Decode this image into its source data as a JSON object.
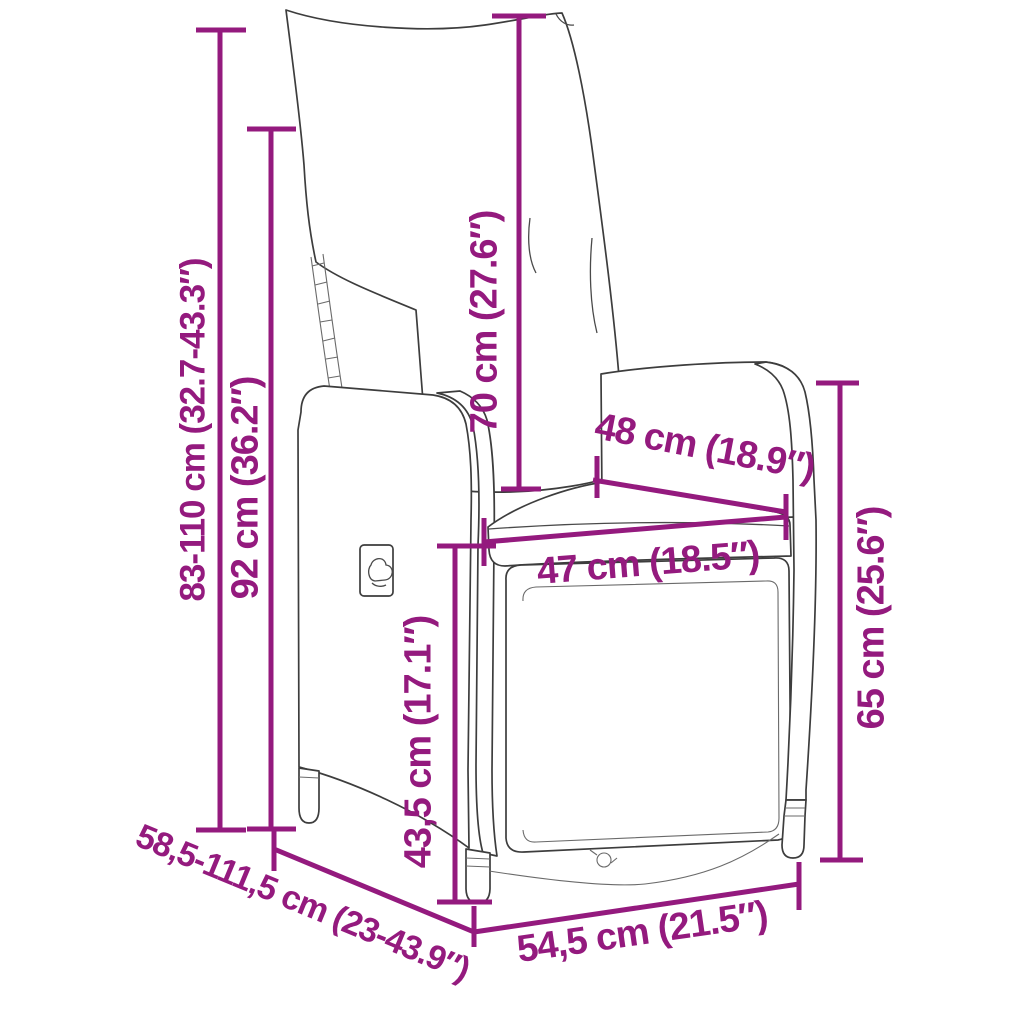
{
  "colors": {
    "accent": "#941A7E",
    "line_art": "#3d3d3d",
    "background": "#ffffff"
  },
  "diagram": {
    "kind": "product-dimension-diagram",
    "subject": "reclining rattan garden chair with cushions, front-left view"
  },
  "dims": [
    {
      "id": "overall-height-range",
      "text": "83-110 cm (32.7-43.3″)",
      "orientation": "vertical"
    },
    {
      "id": "backrest-height",
      "text": "92 cm (36.2″)",
      "orientation": "vertical"
    },
    {
      "id": "back-cushion-height",
      "text": "70 cm (27.6″)",
      "orientation": "vertical"
    },
    {
      "id": "seat-depth",
      "text": "48 cm (18.9″)",
      "orientation": "diagonal"
    },
    {
      "id": "seat-width",
      "text": "47 cm (18.5″)",
      "orientation": "horizontal"
    },
    {
      "id": "armrest-height",
      "text": "65 cm (25.6″)",
      "orientation": "vertical"
    },
    {
      "id": "seat-height",
      "text": "43,5 cm (17.1″)",
      "orientation": "vertical"
    },
    {
      "id": "overall-depth-range",
      "text": "58,5-111,5 cm (23-43.9″)",
      "orientation": "diagonal"
    },
    {
      "id": "base-depth",
      "text": "54,5 cm (21.5″)",
      "orientation": "diagonal"
    }
  ]
}
